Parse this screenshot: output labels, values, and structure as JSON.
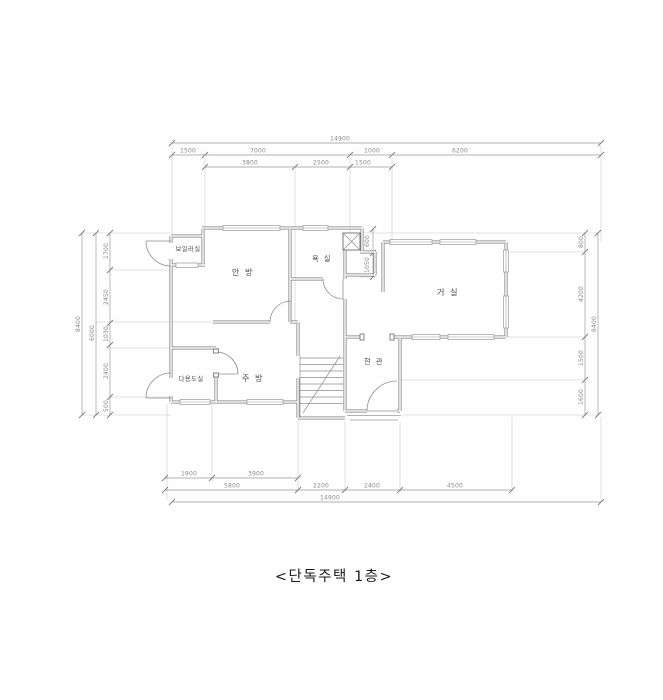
{
  "caption": "<단독주택 1층>",
  "rooms": {
    "boiler": "보일러실",
    "master_bedroom": "안 방",
    "bathroom": "욕 실",
    "living_room": "거 실",
    "utility": "다용도실",
    "kitchen": "주 방",
    "entrance": "현 관"
  },
  "dimensions": {
    "top": {
      "total": "14900",
      "row2": [
        "1500",
        "7000",
        "1000",
        "6200"
      ],
      "row3": [
        "3800",
        "2500",
        "1500"
      ]
    },
    "bottom": {
      "row1": [
        "1900",
        "3900"
      ],
      "row2": [
        "5800",
        "2200",
        "2400",
        "4500"
      ],
      "total": "14900"
    },
    "left": {
      "total": "8400",
      "mid": "6000",
      "segments": [
        "1700",
        "2450",
        "1030",
        "2400",
        "500"
      ]
    },
    "right": {
      "segments": [
        "800",
        "4200",
        "1500",
        "1600"
      ],
      "total": "8400"
    },
    "shaft": [
      "600",
      "1050"
    ]
  }
}
